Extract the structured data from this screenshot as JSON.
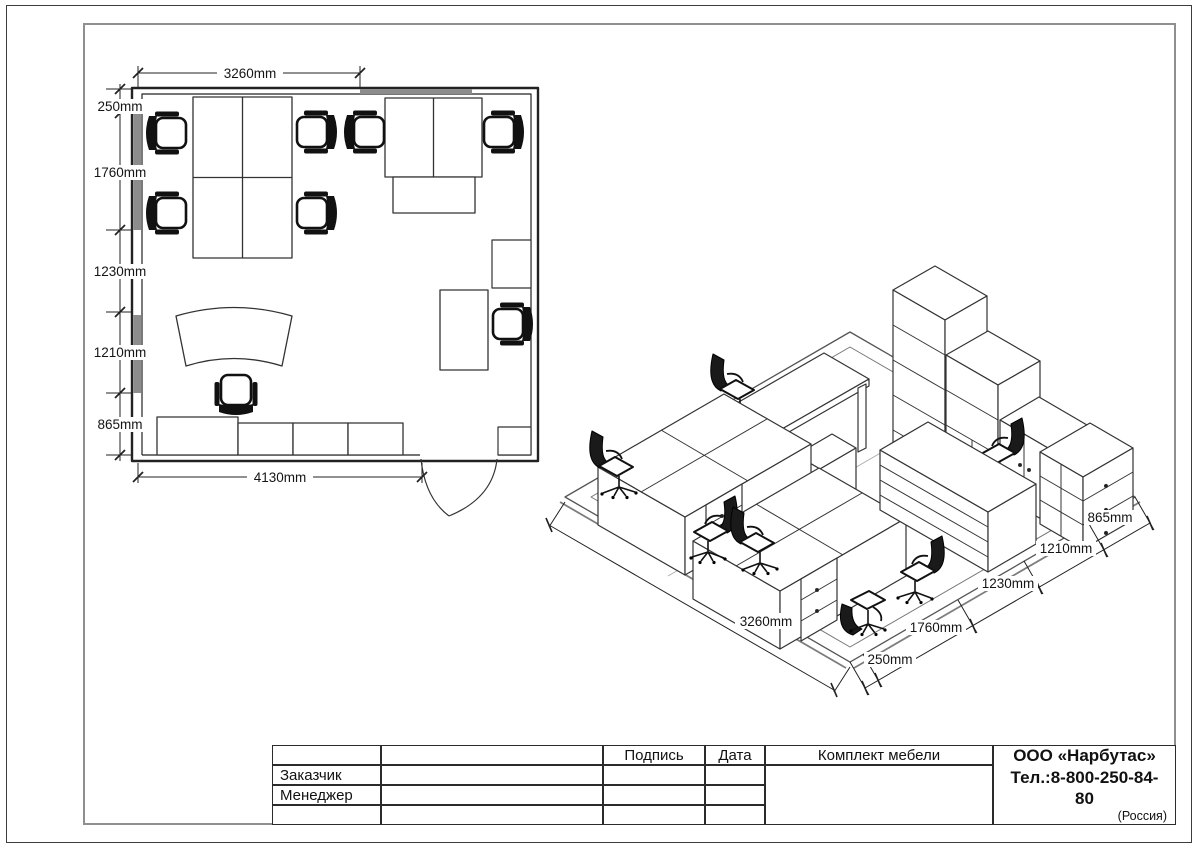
{
  "floor_plan": {
    "dim_top": "3260mm",
    "dim_left": [
      "250mm",
      "1760mm",
      "1230mm",
      "1210mm",
      "865mm"
    ],
    "dim_bottom": "4130mm"
  },
  "isometric": {
    "dim_sw": "3260mm",
    "dim_se": [
      "865mm",
      "1210mm",
      "1230mm",
      "1760mm",
      "250mm"
    ]
  },
  "title_block": {
    "signature": "Подпись",
    "date": "Дата",
    "customer": "Заказчик",
    "manager": "Менеджер",
    "set": "Комплект мебели",
    "company_name": "ООО «Нарбутас»",
    "company_phone": "Тел.:8-800-250-84-80",
    "company_country": "(Россия)"
  }
}
